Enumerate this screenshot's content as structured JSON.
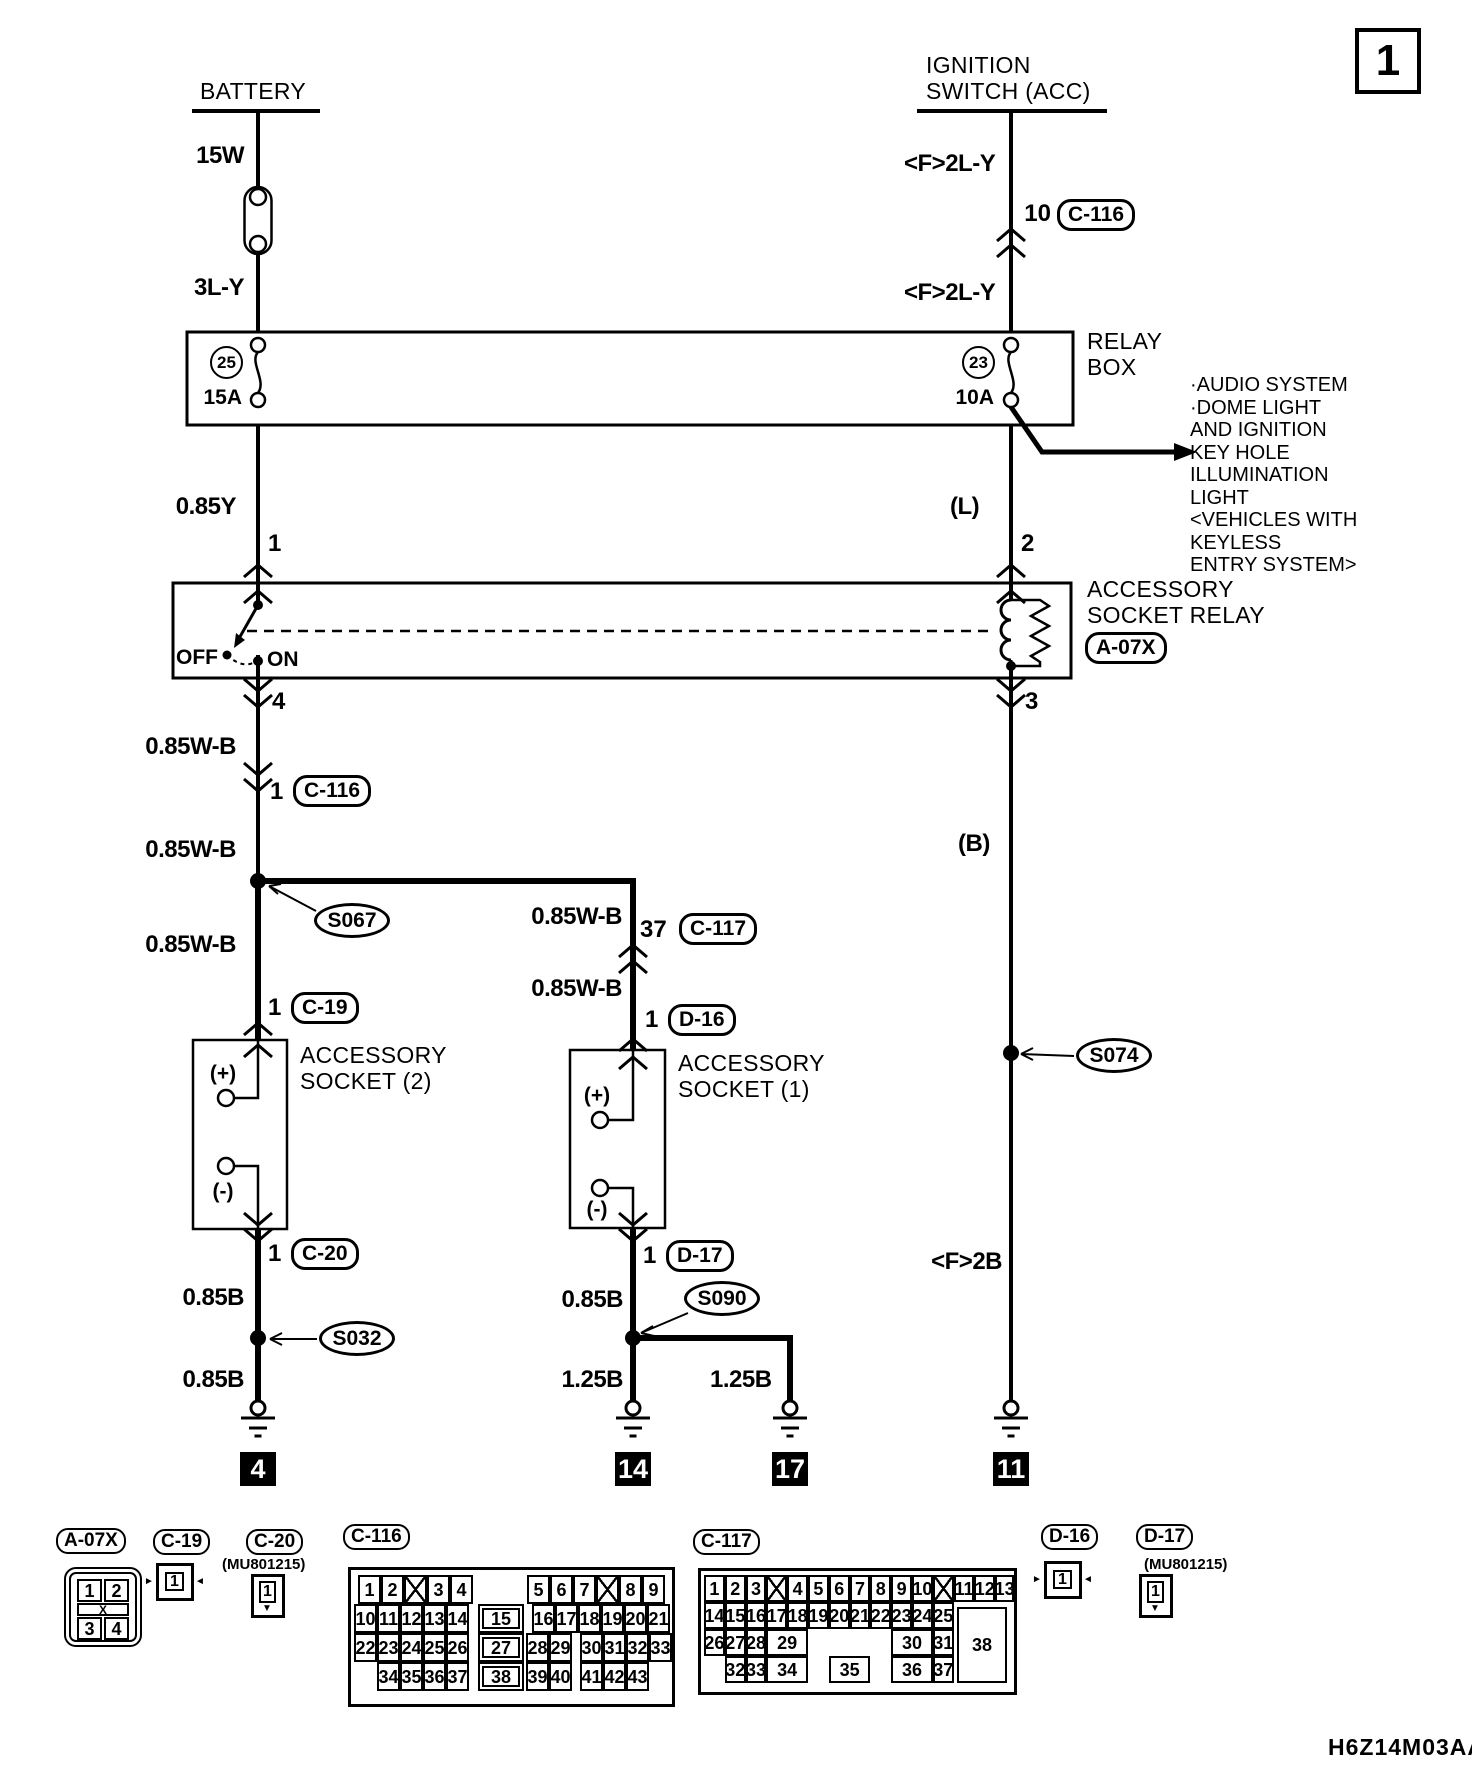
{
  "sheet": {
    "number": "1",
    "code": "H6Z14M03AA"
  },
  "sources": {
    "battery": "BATTERY",
    "ignition": "IGNITION\nSWITCH (ACC)"
  },
  "relay_box": {
    "name": "RELAY\nBOX",
    "fuse_left_no": "25",
    "fuse_left_amp": "15A",
    "fuse_right_no": "23",
    "fuse_right_amp": "10A"
  },
  "note": "·AUDIO SYSTEM\n·DOME LIGHT\nAND IGNITION\nKEY HOLE\nILLUMINATION\nLIGHT\n<VEHICLES WITH\nKEYLESS\nENTRY SYSTEM>",
  "acc_relay": {
    "name": "ACCESSORY\nSOCKET RELAY",
    "off": "OFF",
    "on": "ON"
  },
  "wires": {
    "w15w": "15W",
    "w3ly": "3L-Y",
    "f2ly": "<F>2L-Y",
    "w085y": "0.85Y",
    "wl": "(L)",
    "w085wb": "0.85W-B",
    "wb": "(B)",
    "w085b": "0.85B",
    "w125b": "1.25B",
    "f2b": "<F>2B"
  },
  "pins": {
    "p10": "10",
    "p1": "1",
    "p2": "2",
    "p3": "3",
    "p4": "4",
    "p37": "37"
  },
  "connectors": {
    "c116": "C-116",
    "c117": "C-117",
    "c19": "C-19",
    "c20": "C-20",
    "d16": "D-16",
    "d17": "D-17",
    "a07x": "A-07X",
    "mu": "(MU801215)"
  },
  "splices": {
    "s067": "S067",
    "s032": "S032",
    "s090": "S090",
    "s074": "S074"
  },
  "sockets": {
    "s2": "ACCESSORY\nSOCKET (2)",
    "s1": "ACCESSORY\nSOCKET (1)",
    "plus": "(+)",
    "minus": "(-)"
  },
  "grounds": {
    "g4": "4",
    "g14": "14",
    "g17": "17",
    "g11": "11"
  },
  "pinouts": {
    "a07x": {
      "x": 64,
      "y": 1567,
      "w": 78,
      "h": 80,
      "style": "rounded",
      "cells": [
        [
          "1",
          6,
          5,
          25,
          23
        ],
        [
          "2",
          33,
          5,
          25,
          23
        ],
        [
          "X",
          6,
          29,
          52,
          13,
          "band",
          12
        ],
        [
          "3",
          6,
          43,
          25,
          23
        ],
        [
          "4",
          33,
          43,
          25,
          23
        ]
      ]
    },
    "c19": {
      "x": 156,
      "y": 1563,
      "w": 38,
      "h": 38,
      "cells": [
        [
          "1",
          6,
          6,
          19,
          19,
          null,
          16
        ],
        [
          "►",
          -16,
          8,
          12,
          15,
          "arrow",
          10
        ],
        [
          "◄",
          35,
          8,
          12,
          15,
          "arrow",
          10
        ]
      ]
    },
    "c20": {
      "x": 251,
      "y": 1574,
      "w": 34,
      "h": 44,
      "cells": [
        [
          "1",
          5,
          4,
          17,
          22,
          null,
          16
        ],
        [
          "▼",
          6,
          26,
          14,
          12,
          "tail",
          10
        ]
      ]
    },
    "c116": {
      "x": 348,
      "y": 1567,
      "w": 327,
      "h": 140,
      "cells": [
        [
          "1",
          7,
          5,
          23,
          29
        ],
        [
          "2",
          30,
          5,
          23,
          29
        ],
        [
          "",
          53,
          5,
          23,
          29,
          "x"
        ],
        [
          "3",
          76,
          5,
          23,
          29
        ],
        [
          "4",
          99,
          5,
          23,
          29
        ],
        [
          "5",
          176,
          5,
          23,
          29
        ],
        [
          "6",
          199,
          5,
          23,
          29
        ],
        [
          "7",
          222,
          5,
          23,
          29
        ],
        [
          "",
          245,
          5,
          23,
          29,
          "x"
        ],
        [
          "8",
          268,
          5,
          23,
          29
        ],
        [
          "9",
          291,
          5,
          23,
          29
        ],
        [
          "10",
          3,
          34,
          23,
          29
        ],
        [
          "11",
          26,
          34,
          23,
          29
        ],
        [
          "12",
          49,
          34,
          23,
          29
        ],
        [
          "13",
          72,
          34,
          23,
          29
        ],
        [
          "14",
          95,
          34,
          23,
          29
        ],
        [
          "15",
          127,
          34,
          46,
          29,
          "wide"
        ],
        [
          "16",
          181,
          34,
          23,
          29
        ],
        [
          "17",
          204,
          34,
          23,
          29
        ],
        [
          "18",
          227,
          34,
          23,
          29
        ],
        [
          "19",
          250,
          34,
          23,
          29
        ],
        [
          "20",
          273,
          34,
          23,
          29
        ],
        [
          "21",
          296,
          34,
          23,
          29
        ],
        [
          "22",
          3,
          63,
          23,
          29
        ],
        [
          "23",
          26,
          63,
          23,
          29
        ],
        [
          "24",
          49,
          63,
          23,
          29
        ],
        [
          "25",
          72,
          63,
          23,
          29
        ],
        [
          "26",
          95,
          63,
          23,
          29
        ],
        [
          "27",
          127,
          63,
          46,
          29,
          "wide"
        ],
        [
          "28",
          175,
          63,
          23,
          29
        ],
        [
          "29",
          198,
          63,
          23,
          29
        ],
        [
          "30",
          229,
          63,
          23,
          29
        ],
        [
          "31",
          252,
          63,
          23,
          29
        ],
        [
          "32",
          275,
          63,
          23,
          29
        ],
        [
          "33",
          298,
          63,
          23,
          29
        ],
        [
          "34",
          26,
          92,
          23,
          29
        ],
        [
          "35",
          49,
          92,
          23,
          29
        ],
        [
          "36",
          72,
          92,
          23,
          29
        ],
        [
          "37",
          95,
          92,
          23,
          29
        ],
        [
          "38",
          127,
          92,
          46,
          29,
          "wide"
        ],
        [
          "39",
          175,
          92,
          23,
          29
        ],
        [
          "40",
          198,
          92,
          23,
          29
        ],
        [
          "41",
          229,
          92,
          23,
          29
        ],
        [
          "42",
          252,
          92,
          23,
          29
        ],
        [
          "43",
          275,
          92,
          23,
          29
        ]
      ]
    },
    "c117": {
      "x": 698,
      "y": 1568,
      "w": 319,
      "h": 127,
      "cells": [
        [
          "1",
          3,
          4,
          20.8,
          27
        ],
        [
          "2",
          23.8,
          4,
          20.8,
          27
        ],
        [
          "3",
          44.6,
          4,
          20.8,
          27
        ],
        [
          "",
          65.4,
          4,
          20.8,
          27,
          "x"
        ],
        [
          "4",
          86.2,
          4,
          20.8,
          27
        ],
        [
          "5",
          107,
          4,
          20.8,
          27
        ],
        [
          "6",
          127.8,
          4,
          20.8,
          27
        ],
        [
          "7",
          148.6,
          4,
          20.8,
          27
        ],
        [
          "8",
          169.4,
          4,
          20.8,
          27
        ],
        [
          "9",
          190.2,
          4,
          20.8,
          27
        ],
        [
          "10",
          211,
          4,
          20.8,
          27
        ],
        [
          "",
          231.8,
          4,
          20.8,
          27,
          "x"
        ],
        [
          "11",
          252.6,
          4,
          20.8,
          27
        ],
        [
          "12",
          273.4,
          4,
          20.8,
          27
        ],
        [
          "13",
          294.2,
          4,
          19,
          27
        ],
        [
          "14",
          3,
          31,
          20.8,
          27
        ],
        [
          "15",
          23.8,
          31,
          20.8,
          27
        ],
        [
          "16",
          44.6,
          31,
          20.8,
          27
        ],
        [
          "17",
          65.4,
          31,
          20.8,
          27
        ],
        [
          "18",
          86.2,
          31,
          20.8,
          27
        ],
        [
          "19",
          107,
          31,
          20.8,
          27
        ],
        [
          "20",
          127.8,
          31,
          20.8,
          27
        ],
        [
          "21",
          148.6,
          31,
          20.8,
          27
        ],
        [
          "22",
          169.4,
          31,
          20.8,
          27
        ],
        [
          "23",
          190.2,
          31,
          20.8,
          27
        ],
        [
          "24",
          211,
          31,
          20.8,
          27
        ],
        [
          "25",
          231.8,
          31,
          20.8,
          27
        ],
        [
          "26",
          3,
          58,
          20.8,
          27
        ],
        [
          "27",
          23.8,
          58,
          20.8,
          27
        ],
        [
          "28",
          44.6,
          58,
          20.8,
          27
        ],
        [
          "29",
          65.4,
          58,
          41.6,
          27
        ],
        [
          "30",
          190.2,
          58,
          41.6,
          27
        ],
        [
          "31",
          231.8,
          58,
          20.8,
          27
        ],
        [
          "32",
          23.8,
          85,
          20.8,
          27
        ],
        [
          "33",
          44.6,
          85,
          20.8,
          27
        ],
        [
          "34",
          65.4,
          85,
          41.6,
          27
        ],
        [
          "35",
          127.8,
          85,
          41.6,
          27
        ],
        [
          "36",
          190.2,
          85,
          41.6,
          27
        ],
        [
          "37",
          231.8,
          85,
          20.8,
          27
        ],
        [
          "38",
          256,
          36,
          50,
          76,
          "big"
        ]
      ]
    },
    "d16": {
      "x": 1044,
      "y": 1561,
      "w": 38,
      "h": 38,
      "cells": [
        [
          "1",
          6,
          6,
          19,
          19,
          null,
          16
        ],
        [
          "►",
          -16,
          8,
          12,
          15,
          "arrow",
          10
        ],
        [
          "◄",
          35,
          8,
          12,
          15,
          "arrow",
          10
        ]
      ]
    },
    "d17": {
      "x": 1139,
      "y": 1574,
      "w": 34,
      "h": 44,
      "cells": [
        [
          "1",
          5,
          4,
          17,
          22,
          null,
          16
        ],
        [
          "▼",
          6,
          26,
          14,
          12,
          "tail",
          10
        ]
      ]
    }
  }
}
